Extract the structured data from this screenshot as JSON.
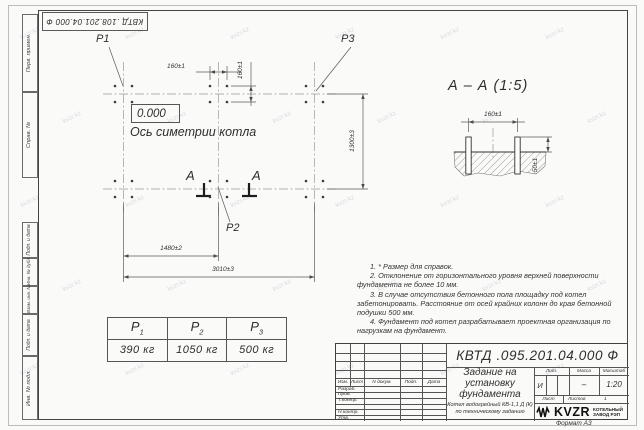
{
  "watermark": {
    "text": "kvzr.kz"
  },
  "stamps": {
    "top_left": "КВТД .108.201.04.000  Ф",
    "format": "Формат А3"
  },
  "margin_labels": [
    "Перв. примен.",
    "Справ. №",
    "Подп. и дата",
    "Инв. № дубл.",
    "Взам. инв. №",
    "Подп. и дата",
    "Инв. № подл."
  ],
  "plan": {
    "p1": "Р1",
    "p2": "Р2",
    "p3": "Р3",
    "elevation": "0.000",
    "axis_label": "Ось симетрии котла",
    "cut_letter_left": "А",
    "cut_letter_right": "А",
    "dims": {
      "top_160": "160±1",
      "side_160": "160±1",
      "v_1300": "1300±3",
      "h_1480": "1480±2",
      "h_3010": "3010±3"
    }
  },
  "section": {
    "title": "А – А (1:5)",
    "dim_160": "160±1",
    "dim_50": "50±1"
  },
  "loads_table": {
    "headers": [
      {
        "p": "Р",
        "sub": "1"
      },
      {
        "p": "Р",
        "sub": "2"
      },
      {
        "p": "Р",
        "sub": "3"
      }
    ],
    "values": [
      "390 кг",
      "1050 кг",
      "500 кг"
    ]
  },
  "notes": [
    "1.  * Размер для справок.",
    "2.  Отклонение от горизонтального уровня верхней поверхности фундамента не более 10 мм.",
    "3.  В случае отсутствия бетонного пола площадку под котел забетонировать. Расстояние от осей крайних колонн до края бетонной подушки 500 мм.",
    "4.  Фундамент под котел разрабатывает проектная организация по нагрузкам на фундамент."
  ],
  "title_block": {
    "doc_number": "КВТД .095.201.04.000  Ф",
    "title": "Задание на установку фундамента",
    "subtitle": "Котел водогрейный КВ-1,1 Д (К) по техническому заданию",
    "sig_header": [
      "Изм.",
      "Лист",
      "N докум.",
      "Подп.",
      "Дата"
    ],
    "sig_rows": [
      "Разраб.",
      "Пров.",
      "Т.контр.",
      "",
      "Н.контр.",
      "Утв."
    ],
    "lit_label": "Лит.",
    "mass_label": "Масса",
    "scale_label": "Масштаб",
    "lit_value": "И",
    "mass_value": "–",
    "scale_value": "1:20",
    "sheets_row": {
      "sheet_label": "Лист",
      "sheets_label": "Листов",
      "sheets_value": "1"
    },
    "company": {
      "logo": "KVZR",
      "name": "КОТЕЛЬНЫЙ ЗАВОД РЭП"
    }
  }
}
